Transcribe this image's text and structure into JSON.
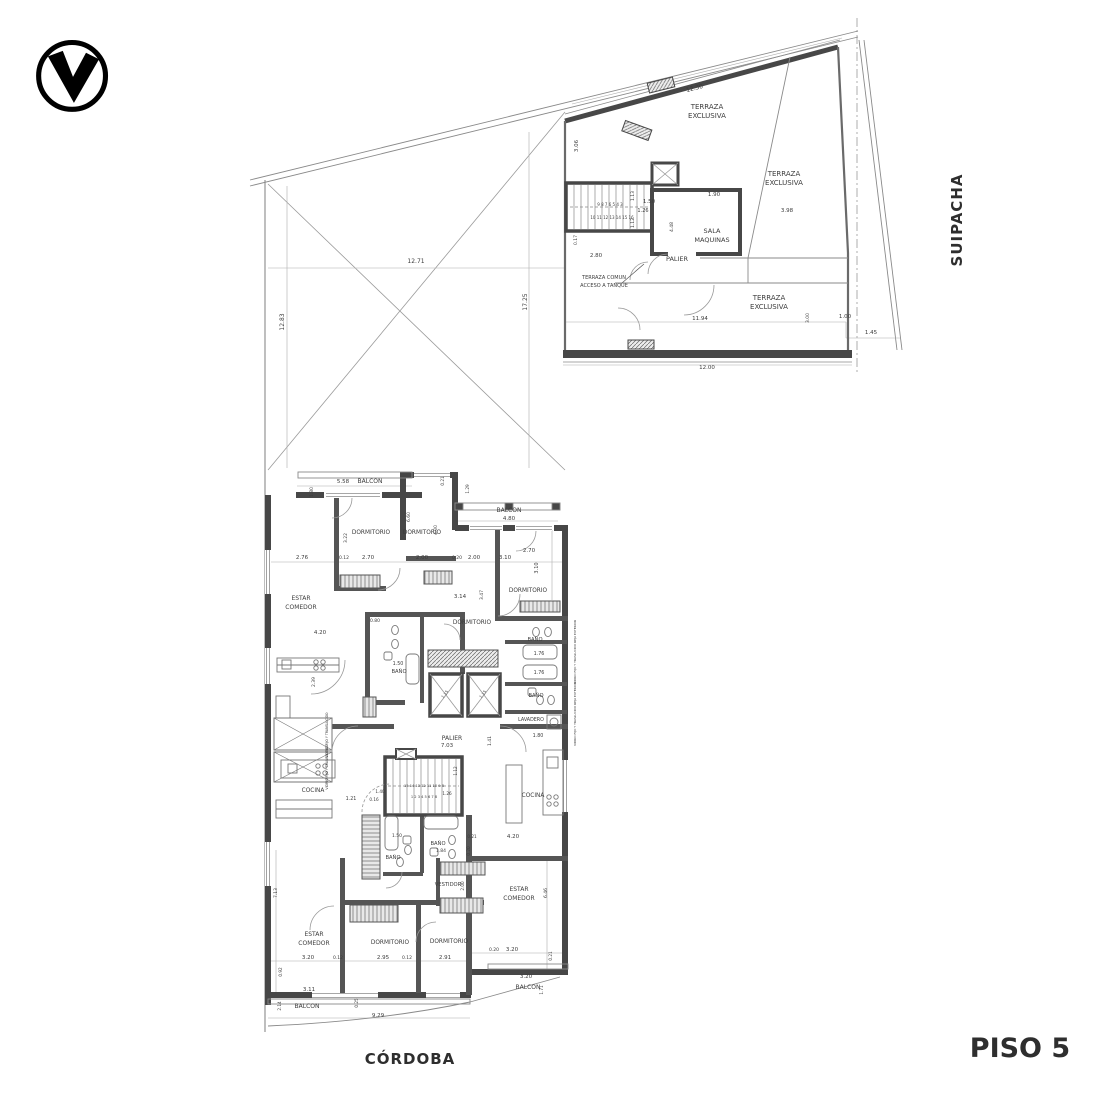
{
  "meta": {
    "floor_title": "PISO 5",
    "street_bottom": "CÓRDOBA",
    "street_right": "SUIPACHA",
    "line_color": "#8a8a8a",
    "wall_color": "#474747"
  },
  "logo": {
    "icon": "v-in-circle"
  },
  "plan": {
    "labels": [
      {
        "t": "TERRAZA",
        "x": 707,
        "y": 109,
        "s": 7
      },
      {
        "t": "EXCLUSIVA",
        "x": 707,
        "y": 118,
        "s": 7
      },
      {
        "t": "TERRAZA",
        "x": 784,
        "y": 176,
        "s": 7
      },
      {
        "t": "EXCLUSIVA",
        "x": 784,
        "y": 185,
        "s": 7
      },
      {
        "t": "TERRAZA",
        "x": 769,
        "y": 300,
        "s": 7
      },
      {
        "t": "EXCLUSIVA",
        "x": 769,
        "y": 309,
        "s": 7
      },
      {
        "t": "SALA",
        "x": 712,
        "y": 233,
        "s": 6.5
      },
      {
        "t": "MAQUINAS",
        "x": 712,
        "y": 242,
        "s": 6.5
      },
      {
        "t": "PALIER",
        "x": 677,
        "y": 261,
        "s": 6.5
      },
      {
        "t": "TERRAZA COMUN",
        "x": 604,
        "y": 279,
        "s": 5
      },
      {
        "t": "ACCESO A TANQUE",
        "x": 604,
        "y": 287,
        "s": 5
      },
      {
        "t": "12.30",
        "x": 695,
        "y": 90,
        "s": 6,
        "r": -14
      },
      {
        "t": "3.06",
        "x": 578,
        "y": 146,
        "s": 5.5,
        "r": -90
      },
      {
        "t": "1.50",
        "x": 649,
        "y": 203,
        "s": 5.5
      },
      {
        "t": "1.90",
        "x": 714,
        "y": 196,
        "s": 5.5
      },
      {
        "t": "3.98",
        "x": 787,
        "y": 212,
        "s": 5.5
      },
      {
        "t": "1.26",
        "x": 643,
        "y": 212,
        "s": 5
      },
      {
        "t": "1.13",
        "x": 634,
        "y": 196,
        "s": 4.5,
        "r": -90
      },
      {
        "t": "1.12",
        "x": 634,
        "y": 223,
        "s": 4.5,
        "r": -90
      },
      {
        "t": "4.48",
        "x": 673,
        "y": 227,
        "s": 4.5,
        "r": -90
      },
      {
        "t": "2.80",
        "x": 596,
        "y": 257,
        "s": 5.5
      },
      {
        "t": "0.17",
        "x": 577,
        "y": 240,
        "s": 4.5,
        "r": -90
      },
      {
        "t": "11.94",
        "x": 700,
        "y": 320,
        "s": 5.5
      },
      {
        "t": "3.00",
        "x": 809,
        "y": 318,
        "s": 4.5,
        "r": -90
      },
      {
        "t": "1.00",
        "x": 845,
        "y": 318,
        "s": 5.5
      },
      {
        "t": "1.45",
        "x": 871,
        "y": 334,
        "s": 5.5
      },
      {
        "t": "12.00",
        "x": 707,
        "y": 369,
        "s": 5.5
      },
      {
        "t": "9 8 7 6 5 4 3",
        "x": 610,
        "y": 206,
        "s": 4
      },
      {
        "t": "10 11 12 13 14 15 16",
        "x": 612,
        "y": 219,
        "s": 4
      },
      {
        "t": "17.25",
        "x": 527,
        "y": 302,
        "s": 6,
        "r": -90
      },
      {
        "t": "12.71",
        "x": 416,
        "y": 263,
        "s": 6
      },
      {
        "t": "12.83",
        "x": 284,
        "y": 322,
        "s": 6,
        "r": -90
      },
      {
        "t": "BALCON",
        "x": 370,
        "y": 483,
        "s": 6
      },
      {
        "t": "5.58",
        "x": 343,
        "y": 483,
        "s": 5.5
      },
      {
        "t": "DORMITORIO",
        "x": 371,
        "y": 534,
        "s": 5.8
      },
      {
        "t": "DORMITORIO",
        "x": 422,
        "y": 534,
        "s": 5.8
      },
      {
        "t": "BALCON",
        "x": 509,
        "y": 512,
        "s": 6
      },
      {
        "t": "4.80",
        "x": 509,
        "y": 520,
        "s": 5.5
      },
      {
        "t": "DORMITORIO",
        "x": 528,
        "y": 592,
        "s": 5.8
      },
      {
        "t": "ESTAR",
        "x": 301,
        "y": 600,
        "s": 6
      },
      {
        "t": "COMEDOR",
        "x": 301,
        "y": 609,
        "s": 6
      },
      {
        "t": "2.76",
        "x": 302,
        "y": 559,
        "s": 5.5
      },
      {
        "t": "0.12",
        "x": 344,
        "y": 559,
        "s": 4.5
      },
      {
        "t": "2.70",
        "x": 368,
        "y": 559,
        "s": 5.5
      },
      {
        "t": "2.00",
        "x": 422,
        "y": 559,
        "s": 5.5
      },
      {
        "t": "0.20",
        "x": 457,
        "y": 559,
        "s": 4.5
      },
      {
        "t": "2.00",
        "x": 474,
        "y": 559,
        "s": 5.5
      },
      {
        "t": "3.10",
        "x": 505,
        "y": 559,
        "s": 5.5
      },
      {
        "t": "2.70",
        "x": 529,
        "y": 552,
        "s": 5.5
      },
      {
        "t": "3.10",
        "x": 538,
        "y": 568,
        "s": 5,
        "r": -90
      },
      {
        "t": "1.80",
        "x": 313,
        "y": 492,
        "s": 4.5,
        "r": -90
      },
      {
        "t": "3.22",
        "x": 347,
        "y": 538,
        "s": 4.5,
        "r": -90
      },
      {
        "t": "6.60",
        "x": 410,
        "y": 517,
        "s": 4.5,
        "r": -90
      },
      {
        "t": "4.00",
        "x": 437,
        "y": 530,
        "s": 4.5,
        "r": -90
      },
      {
        "t": "0.21",
        "x": 444,
        "y": 481,
        "s": 4.2,
        "r": -90
      },
      {
        "t": "1.29",
        "x": 469,
        "y": 489,
        "s": 4.2,
        "r": -90
      },
      {
        "t": "4.20",
        "x": 320,
        "y": 634,
        "s": 5.5
      },
      {
        "t": "2.39",
        "x": 315,
        "y": 682,
        "s": 4.5,
        "r": -90
      },
      {
        "t": "0.80",
        "x": 375,
        "y": 622,
        "s": 4.5
      },
      {
        "t": "3.14",
        "x": 460,
        "y": 598,
        "s": 5.5
      },
      {
        "t": "3.47",
        "x": 483,
        "y": 595,
        "s": 4.5,
        "r": -90
      },
      {
        "t": "DORMITORIO",
        "x": 472,
        "y": 624,
        "s": 5.8
      },
      {
        "t": "BAÑO",
        "x": 535,
        "y": 641,
        "s": 5.2
      },
      {
        "t": "1.76",
        "x": 539,
        "y": 655,
        "s": 4.8
      },
      {
        "t": "1.76",
        "x": 539,
        "y": 674,
        "s": 4.8
      },
      {
        "t": "BAÑO",
        "x": 536,
        "y": 697,
        "s": 5.2
      },
      {
        "t": "LAVADERO",
        "x": 531,
        "y": 721,
        "s": 4.8
      },
      {
        "t": "1.50",
        "x": 398,
        "y": 665,
        "s": 4.8
      },
      {
        "t": "BAÑO",
        "x": 399,
        "y": 673,
        "s": 5.2
      },
      {
        "t": "PALIER",
        "x": 452,
        "y": 740,
        "s": 6
      },
      {
        "t": "7.03",
        "x": 447,
        "y": 747,
        "s": 5.5
      },
      {
        "t": "1.41",
        "x": 491,
        "y": 741,
        "s": 4.5,
        "r": -90
      },
      {
        "t": "COCINA",
        "x": 313,
        "y": 792,
        "s": 5.8
      },
      {
        "t": "1.21",
        "x": 351,
        "y": 800,
        "s": 4.8
      },
      {
        "t": "0.16",
        "x": 374,
        "y": 801,
        "s": 4.2
      },
      {
        "t": "1.40",
        "x": 380,
        "y": 793,
        "s": 4.2
      },
      {
        "t": "1.26",
        "x": 447,
        "y": 795,
        "s": 4.2
      },
      {
        "t": "1.12",
        "x": 457,
        "y": 771,
        "s": 4.2,
        "r": -90
      },
      {
        "t": "15 14 13 12 11 10 9 8",
        "x": 424,
        "y": 787,
        "s": 3.6
      },
      {
        "t": "1 2 3 4 5 6 7 8",
        "x": 424,
        "y": 798,
        "s": 3.6
      },
      {
        "t": "COCINA",
        "x": 533,
        "y": 797,
        "s": 5.8
      },
      {
        "t": "1.15",
        "x": 446,
        "y": 695,
        "s": 4,
        "r": -52
      },
      {
        "t": "1.15",
        "x": 484,
        "y": 695,
        "s": 4,
        "r": -52
      },
      {
        "t": "VIDRIO FIJO Y TRANSLUCIDO",
        "x": 328,
        "y": 735,
        "s": 3.2,
        "r": -90
      },
      {
        "t": "VIDRIO FIJO Y TRANSLUCIDO",
        "x": 328,
        "y": 767,
        "s": 3.2,
        "r": -90
      },
      {
        "t": "VIDRIO FIJO Y TRASLUCIDO REJA EXTERIOR",
        "x": 576,
        "y": 652,
        "s": 3,
        "r": -90
      },
      {
        "t": "VIDRIO FIJO Y TRASLUCIDO REJA EXTERIOR",
        "x": 576,
        "y": 714,
        "s": 3,
        "r": -90
      },
      {
        "t": "1.80",
        "x": 538,
        "y": 737,
        "s": 4.8
      },
      {
        "t": "BAÑO",
        "x": 438,
        "y": 845,
        "s": 5.2
      },
      {
        "t": "1.84",
        "x": 441,
        "y": 852,
        "s": 4.5
      },
      {
        "t": "BAÑO",
        "x": 393,
        "y": 859,
        "s": 5.2
      },
      {
        "t": "1.50",
        "x": 397,
        "y": 837,
        "s": 4.5
      },
      {
        "t": "0.21",
        "x": 472,
        "y": 838,
        "s": 4.2
      },
      {
        "t": "4.20",
        "x": 513,
        "y": 838,
        "s": 5.5
      },
      {
        "t": "0.20",
        "x": 470,
        "y": 851,
        "s": 4.2,
        "r": -90
      },
      {
        "t": "VESTIDOR",
        "x": 448,
        "y": 886,
        "s": 5.2
      },
      {
        "t": "2.00",
        "x": 464,
        "y": 886,
        "s": 4.2,
        "r": -90
      },
      {
        "t": "ESTAR",
        "x": 519,
        "y": 891,
        "s": 6
      },
      {
        "t": "COMEDOR",
        "x": 519,
        "y": 900,
        "s": 6
      },
      {
        "t": "6.46",
        "x": 547,
        "y": 893,
        "s": 4.5,
        "r": -90
      },
      {
        "t": "ESTAR",
        "x": 314,
        "y": 936,
        "s": 6
      },
      {
        "t": "COMEDOR",
        "x": 314,
        "y": 945,
        "s": 6
      },
      {
        "t": "DORMITORIO",
        "x": 390,
        "y": 944,
        "s": 5.8
      },
      {
        "t": "DORMITORIO",
        "x": 449,
        "y": 943,
        "s": 5.8
      },
      {
        "t": "3.20",
        "x": 308,
        "y": 959,
        "s": 5.5
      },
      {
        "t": "0.12",
        "x": 338,
        "y": 959,
        "s": 4.5
      },
      {
        "t": "2.95",
        "x": 383,
        "y": 959,
        "s": 5.5
      },
      {
        "t": "0.12",
        "x": 407,
        "y": 959,
        "s": 4.5
      },
      {
        "t": "2.91",
        "x": 445,
        "y": 959,
        "s": 5.5
      },
      {
        "t": "0.20",
        "x": 494,
        "y": 951,
        "s": 4.5
      },
      {
        "t": "3.20",
        "x": 512,
        "y": 951,
        "s": 5.5
      },
      {
        "t": "0.21",
        "x": 552,
        "y": 956,
        "s": 4.2,
        "r": -90
      },
      {
        "t": "3.20",
        "x": 526,
        "y": 978,
        "s": 5.5
      },
      {
        "t": "BALCON",
        "x": 528,
        "y": 989,
        "s": 6
      },
      {
        "t": "1.71",
        "x": 543,
        "y": 990,
        "s": 4.2,
        "r": -90
      },
      {
        "t": "3.11",
        "x": 309,
        "y": 991,
        "s": 5.5
      },
      {
        "t": "0.92",
        "x": 282,
        "y": 972,
        "s": 4.2,
        "r": -90
      },
      {
        "t": "7.13",
        "x": 277,
        "y": 893,
        "s": 4.5,
        "r": -90
      },
      {
        "t": "2.14",
        "x": 281,
        "y": 1006,
        "s": 4.2,
        "r": -90
      },
      {
        "t": "0.25",
        "x": 358,
        "y": 1003,
        "s": 4.2,
        "r": -90
      },
      {
        "t": "BALCON",
        "x": 307,
        "y": 1008,
        "s": 6
      },
      {
        "t": "9.29",
        "x": 378,
        "y": 1017,
        "s": 5.5
      }
    ]
  }
}
